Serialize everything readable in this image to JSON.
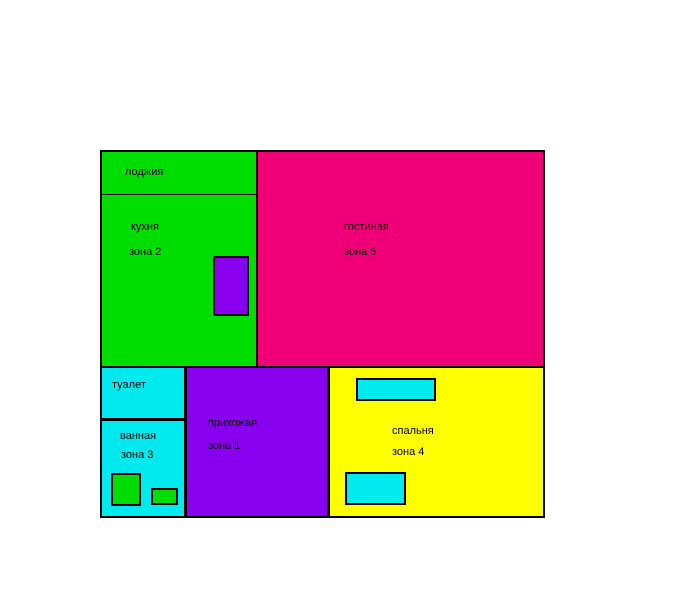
{
  "page": {
    "background_color": "#ffffff",
    "outline_color": "#000000"
  },
  "floor_plan": {
    "rooms": {
      "loggia": {
        "label": "лоджия",
        "color": "#00dd00"
      },
      "kitchen": {
        "label": "кухня",
        "zone": "зона 2",
        "color": "#00dd00"
      },
      "living": {
        "label": "гостиная",
        "zone": "зона 5",
        "color": "#f00078"
      },
      "toilet": {
        "label": "туалет",
        "color": "#00e9ef"
      },
      "bathroom": {
        "label": "ванная",
        "zone": "зона 3",
        "color": "#00e9ef"
      },
      "hallway": {
        "label": "прихожая",
        "zone": "зона 1",
        "color": "#8800ee"
      },
      "bedroom": {
        "label": "спальня",
        "zone": "зона 4",
        "color": "#ffff00"
      }
    },
    "fixtures": {
      "kitchen_block": {
        "color": "#8800ee"
      },
      "bathroom_block_large": {
        "color": "#00dd00"
      },
      "bathroom_block_small": {
        "color": "#00dd00"
      },
      "bedroom_block_top": {
        "color": "#00e9ef"
      },
      "bedroom_block_bottom": {
        "color": "#00e9ef"
      }
    }
  }
}
